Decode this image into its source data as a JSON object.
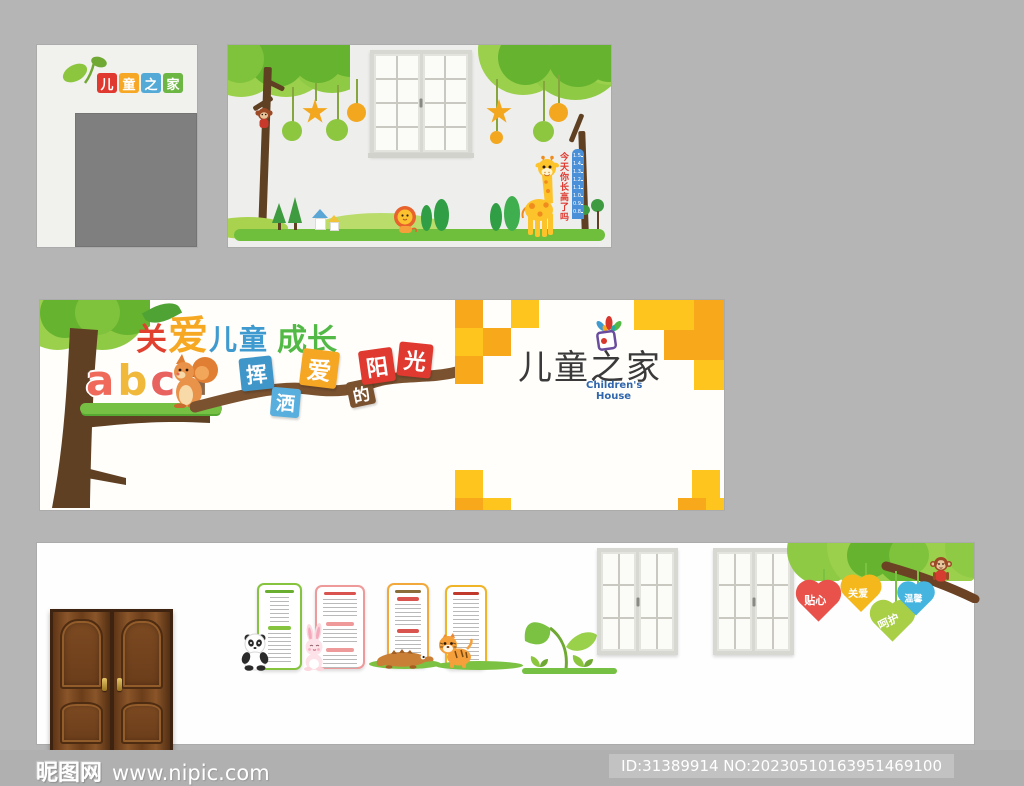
{
  "page": {
    "background": "#b5b5b5",
    "description_colors": {
      "accent_orange": "#f8a81b",
      "accent_yellow": "#fdc51e",
      "grass_green": "#6fbf3c",
      "leaf_light": "#9bd04c",
      "leaf_dark": "#66b32f",
      "trunk_brown": "#5f4023",
      "branch_brown": "#7a5230"
    }
  },
  "top_left_panel": {
    "logo_chars": [
      {
        "text": "儿",
        "color": "#e0392f"
      },
      {
        "text": "童",
        "color": "#f6a723"
      },
      {
        "text": "之",
        "color": "#53aad7"
      },
      {
        "text": "家",
        "color": "#6cb644"
      }
    ]
  },
  "top_mid_panel": {
    "growth_question": "今天你长高了吗",
    "ruler_labels": [
      "1.5",
      "1.4",
      "1.3",
      "1.2",
      "1.1",
      "1.0",
      "0.9",
      "0.8"
    ]
  },
  "banner": {
    "title_parts": [
      {
        "text": "关",
        "color": "#e2402f"
      },
      {
        "text": "爱",
        "color": "#f7a823"
      },
      {
        "text": "儿童",
        "color": "#3f9ad0"
      },
      {
        "text": "成长",
        "color": "#52b946"
      }
    ],
    "alphabet_letters": [
      {
        "text": "a",
        "color": "#ef6a5a"
      },
      {
        "text": "b",
        "color": "#f0b93c"
      },
      {
        "text": "c",
        "color": "#e8635f"
      },
      {
        "text": "d",
        "color": "#8d6748"
      }
    ],
    "slogan_tiles": [
      {
        "text": "挥",
        "color": "#3f96c9"
      },
      {
        "text": "洒",
        "color": "#58aedd"
      },
      {
        "text": "爱",
        "color": "#f5a623"
      },
      {
        "text": "的",
        "color": "#7a5230"
      },
      {
        "text": "阳",
        "color": "#e0392f"
      },
      {
        "text": "光",
        "color": "#e0392f"
      }
    ],
    "logo": {
      "title": "儿童之家",
      "subtitle_line1": "Children's",
      "subtitle_line2": "House"
    }
  },
  "bottom_panel": {
    "hearts": [
      {
        "text": "贴心",
        "color": "#e8524a"
      },
      {
        "text": "关爱",
        "color": "#f5b81c"
      },
      {
        "text": "呵护",
        "color": "#a8cf45"
      },
      {
        "text": "温馨",
        "color": "#45b5e0"
      }
    ]
  },
  "watermark": {
    "site_name": "昵图网",
    "site_url": "www.nipic.com",
    "id_label": "ID:31389914 NO:20230510163951469100"
  }
}
